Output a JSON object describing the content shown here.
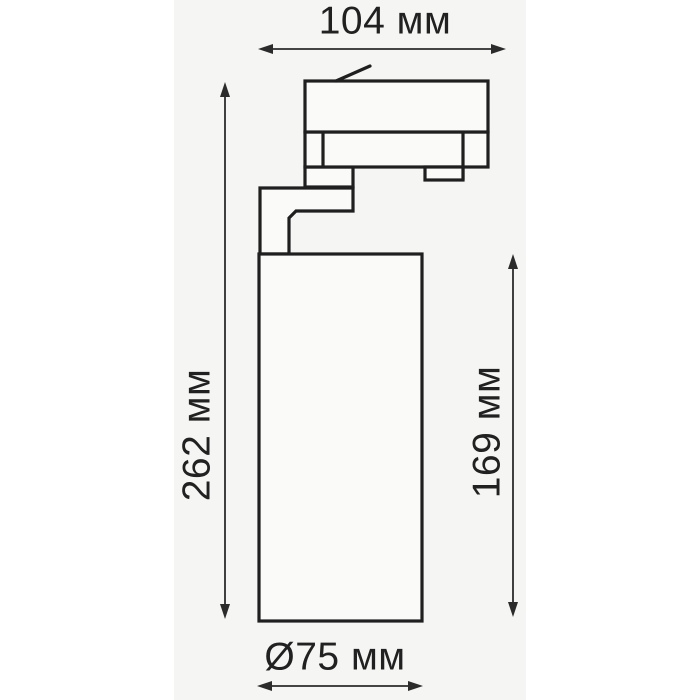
{
  "drawing": {
    "kind": "dimension-drawing",
    "subject": "track-light-spotlight"
  },
  "dimensions": {
    "width": {
      "label": "104 мм",
      "value": 104,
      "unit": "мм"
    },
    "height_total": {
      "label": "262 мм",
      "value": 262,
      "unit": "мм"
    },
    "height_body": {
      "label": "169 мм",
      "value": 169,
      "unit": "мм"
    },
    "diameter": {
      "label": "Ø75 мм",
      "value": 75,
      "unit": "мм"
    }
  },
  "colors": {
    "page_bg": "#ffffff",
    "panel_bg": "#f5f5f3",
    "shape_fill": "#fafaf9",
    "line": "#1f1f1f",
    "dim": "#2b2b2b",
    "ink": "#212121"
  }
}
